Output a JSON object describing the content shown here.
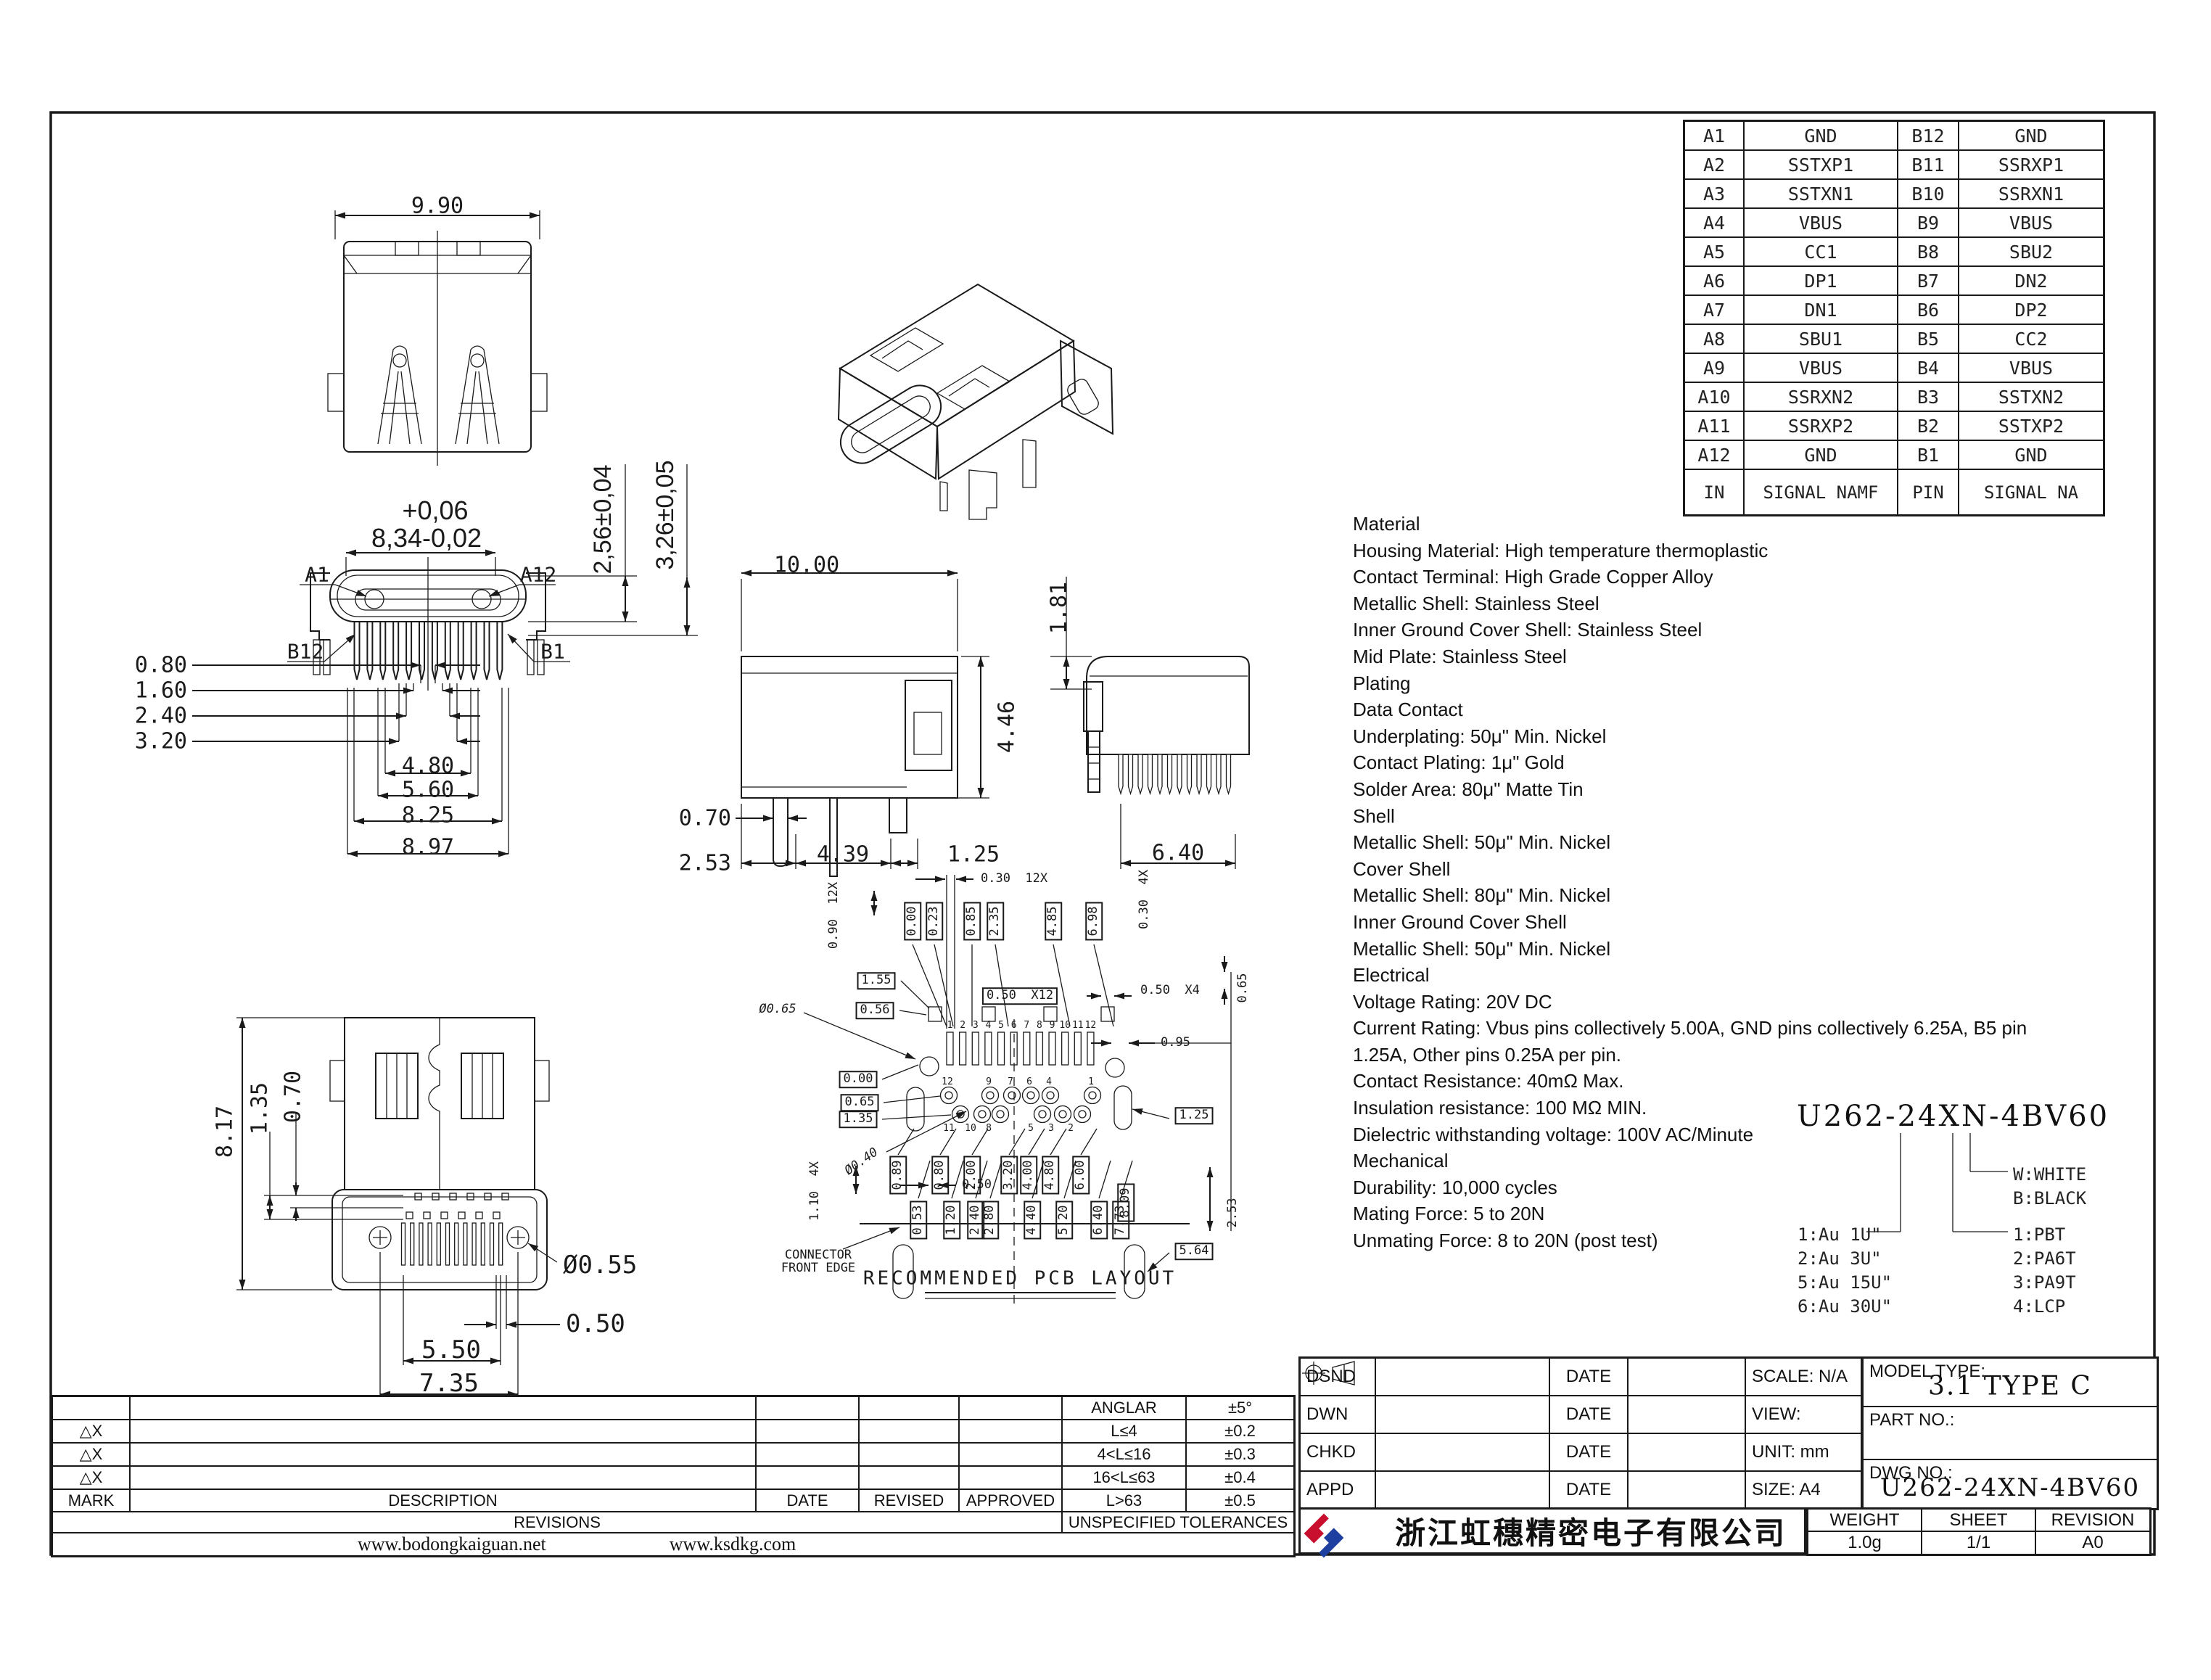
{
  "sheet": {
    "line_color": "#1a1a1a",
    "background": "#ffffff",
    "logo_red": "#c8102e",
    "logo_blue": "#1e3fa0"
  },
  "pin_table": {
    "headers": [
      "IN",
      "SIGNAL NAMF",
      "PIN",
      "SIGNAL NA"
    ],
    "rows": [
      [
        "A1",
        "GND",
        "B12",
        "GND"
      ],
      [
        "A2",
        "SSTXP1",
        "B11",
        "SSRXP1"
      ],
      [
        "A3",
        "SSTXN1",
        "B10",
        "SSRXN1"
      ],
      [
        "A4",
        "VBUS",
        "B9",
        "VBUS"
      ],
      [
        "A5",
        "CC1",
        "B8",
        "SBU2"
      ],
      [
        "A6",
        "DP1",
        "B7",
        "DN2"
      ],
      [
        "A7",
        "DN1",
        "B6",
        "DP2"
      ],
      [
        "A8",
        "SBU1",
        "B5",
        "CC2"
      ],
      [
        "A9",
        "VBUS",
        "B4",
        "VBUS"
      ],
      [
        "A10",
        "SSRXN2",
        "B3",
        "SSTXN2"
      ],
      [
        "A11",
        "SSRXP2",
        "B2",
        "SSTXP2"
      ],
      [
        "A12",
        "GND",
        "B1",
        "GND"
      ]
    ]
  },
  "material_notes": {
    "lines": [
      "Material",
      "Housing Material: High temperature thermoplastic",
      "Contact Terminal: High Grade Copper Alloy",
      "Metallic Shell: Stainless Steel",
      "Inner Ground Cover Shell: Stainless Steel",
      "Mid Plate: Stainless Steel",
      "Plating",
      "Data Contact",
      "Underplating: 50μ\" Min. Nickel",
      "Contact Plating: 1μ\" Gold",
      "Solder Area: 80μ\" Matte Tin",
      "Shell",
      "Metallic Shell: 50μ\" Min. Nickel",
      "Cover Shell",
      "Metallic Shell: 80μ\" Min. Nickel",
      "Inner Ground Cover Shell",
      "Metallic Shell: 50μ\" Min. Nickel",
      "Electrical",
      "Voltage Rating: 20V DC",
      "Current Rating: Vbus pins collectively 5.00A, GND pins collectively 6.25A, B5 pin",
      "1.25A, Other pins 0.25A per pin.",
      "Contact Resistance: 40mΩ Max.",
      "Insulation resistance: 100 MΩ MIN.",
      "Dielectric withstanding voltage: 100V AC/Minute",
      "Mechanical",
      "Durability: 10,000 cycles",
      "Mating Force: 5 to 20N",
      "Unmating Force: 8 to 20N (post test)"
    ]
  },
  "part_code": {
    "code": "U262-24XN-4BV60",
    "plating_options": [
      "1:Au 1U\"",
      "2:Au 3U\"",
      "5:Au 15U\"",
      "6:Au 30U\""
    ],
    "color_options": [
      "W:WHITE",
      "B:BLACK"
    ],
    "housing_options": [
      "1:PBT",
      "2:PA6T",
      "3:PA9T",
      "4:LCP"
    ]
  },
  "views": {
    "top": {
      "width": "9.90"
    },
    "front": {
      "tol_top": "+0,06",
      "width": "8,34-0,02",
      "a1": "A1",
      "a12": "A12",
      "b12": "B12",
      "b1": "B1",
      "h_shell": "2,56±0,04",
      "h_total": "3,26±0,05",
      "pin1": "0.80",
      "pin2": "1.60",
      "pin3": "2.40",
      "pin4": "3.20",
      "w1": "4.80",
      "w2": "5.60",
      "w3": "8.25",
      "w4": "8.97"
    },
    "side": {
      "length": "10.00",
      "height": "4.46",
      "d1": "0.70",
      "d2": "2.53",
      "d3": "4.39",
      "d4": "1.25"
    },
    "end": {
      "offset": "1.81",
      "width": "6.40"
    },
    "bottom": {
      "height": "8.17",
      "o1": "1.35",
      "o2": "0.70",
      "hole": "Ø0.55",
      "pitch": "0.50",
      "w1": "5.50",
      "w2": "7.35"
    }
  },
  "pcb_layout": {
    "title": "RECOMMENDED PCB LAYOUT",
    "edge_note": "CONNECTOR\nFRONT EDGE",
    "top_boxed": [
      "0.00",
      "0.23",
      "0.85",
      "2.35",
      "4.85",
      "6.98"
    ],
    "left_boxed": [
      "1.55",
      "0.56",
      "0.00",
      "0.65",
      "1.35"
    ],
    "bottom_boxed_row1": [
      "0.89",
      "0.80",
      "2.00",
      "3.20",
      "4.00",
      "4.80",
      "6.00"
    ],
    "bottom_boxed_row2": [
      "0.53",
      "1.20",
      "2.40",
      "2.80",
      "4.40",
      "5.20",
      "6.40",
      "7.73"
    ],
    "right_boxed": [
      "1.25",
      "5.64",
      "8.09"
    ],
    "dims": {
      "pad_width": "0.30  12X",
      "pad_height": "0.90  12X",
      "pitch12": "0.50  X12",
      "pitch4": "0.50  X4",
      "pad4_width": "0.30  4X",
      "offset065": "0.65",
      "offset095": "0.95",
      "hole_large": "Ø0.65",
      "hole_small": "Ø0.40",
      "slot_dim": "1.10  4X",
      "depth": "2.53",
      "slot_width": "0.50"
    },
    "pad_numbers": [
      "1",
      "2",
      "3",
      "4",
      "5",
      "6",
      "7",
      "8",
      "9",
      "10",
      "11",
      "12"
    ],
    "hole_numbers_upper": [
      "12",
      "9",
      "7",
      "6",
      "4",
      "1"
    ],
    "hole_numbers_lower": [
      "11",
      "10",
      "8",
      "5",
      "3",
      "2"
    ]
  },
  "revisions": {
    "marks": [
      "△X",
      "△X",
      "△X"
    ],
    "mark_header": "MARK",
    "description_header": "DESCRIPTION",
    "date_header": "DATE",
    "revised_header": "REVISED",
    "approved_header": "APPROVED",
    "title": "REVISIONS",
    "site1": "www.bodongkaiguan.net",
    "site2": "www.ksdkg.com"
  },
  "tolerances": {
    "title": "UNSPECIFIED TOLERANCES",
    "rows": [
      [
        "ANGLAR",
        "±5°"
      ],
      [
        "L≤4",
        "±0.2"
      ],
      [
        "4<L≤16",
        "±0.3"
      ],
      [
        "16<L≤63",
        "±0.4"
      ],
      [
        "L>63",
        "±0.5"
      ]
    ]
  },
  "title_block": {
    "dsnd": "DSND",
    "dwn": "DWN",
    "chkd": "CHKD",
    "appd": "APPD",
    "date": "DATE",
    "scale": "SCALE: N/A",
    "view_label": "VIEW:",
    "unit": "UNIT: mm",
    "size": "SIZE: A4",
    "model_type_label": "MODEL TYPE:",
    "model_type_value": "3.1 TYPE C",
    "part_no_label": "PART NO.:",
    "dwg_no_label": "DWG NO.:",
    "dwg_no_value": "U262-24XN-4BV60",
    "company_name": "浙江虹穗精密电子有限公司",
    "weight_label": "WEIGHT",
    "weight_value": "1.0g",
    "sheet_label": "SHEET",
    "sheet_value": "1/1",
    "revision_label": "REVISION",
    "revision_value": "A0"
  }
}
